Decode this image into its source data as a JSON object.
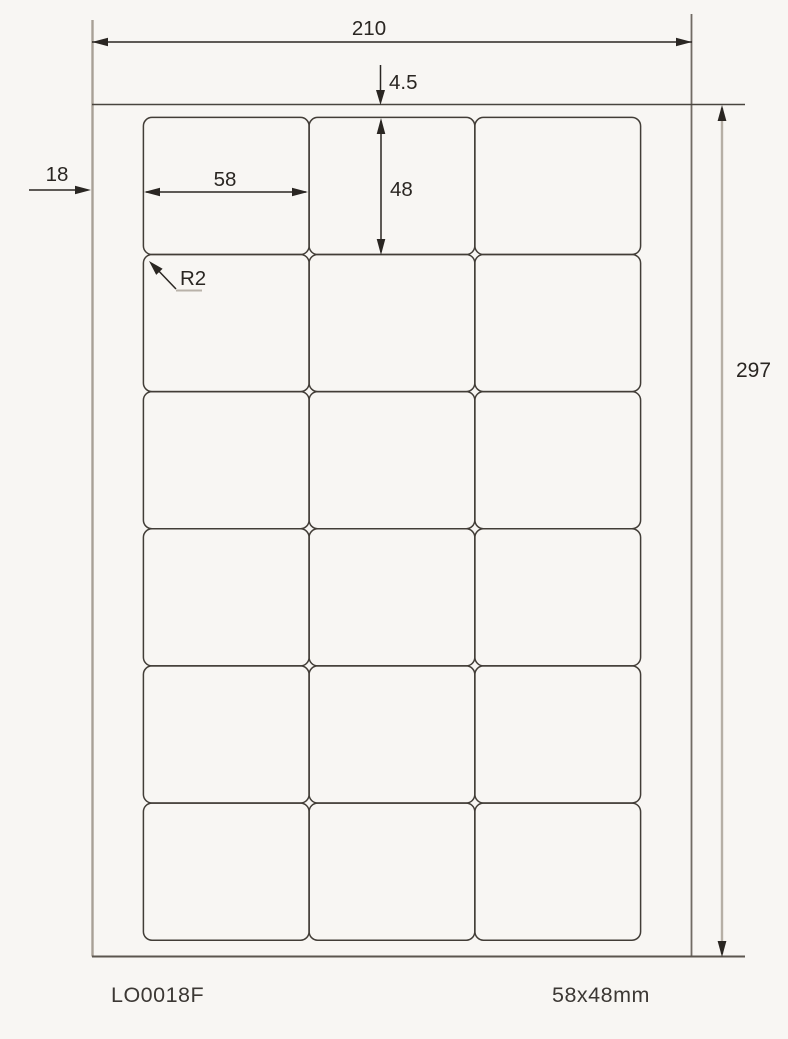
{
  "colors": {
    "bg": "#f8f6f3",
    "ink": "#2a2622",
    "sheet-top": "#49443e",
    "sheet-bottom": "#5c564f",
    "sheet-left": "#a8a096",
    "sheet-right": "#716b64",
    "label-edge": "#423d37",
    "dim297": "#b6afa5",
    "underline": "#b9b2a9",
    "footer-ink": "#3c3834"
  },
  "sheet": {
    "grid": {
      "rows": 6,
      "cols": 3,
      "label_width_mm": 58,
      "label_height_mm": 48,
      "left_margin_mm": 18,
      "top_margin_mm": 4.5,
      "corner_radius_mm": 2,
      "sheet_width_mm": 210,
      "sheet_height_mm": 297
    }
  },
  "dimensions": {
    "page_width": "210",
    "top_margin": "4.5",
    "left_margin": "18",
    "label_width": "58",
    "label_height": "48",
    "corner_radius": "R2",
    "page_height": "297"
  },
  "footer": {
    "product_code": "LO0018F",
    "label_size": "58x48mm"
  }
}
